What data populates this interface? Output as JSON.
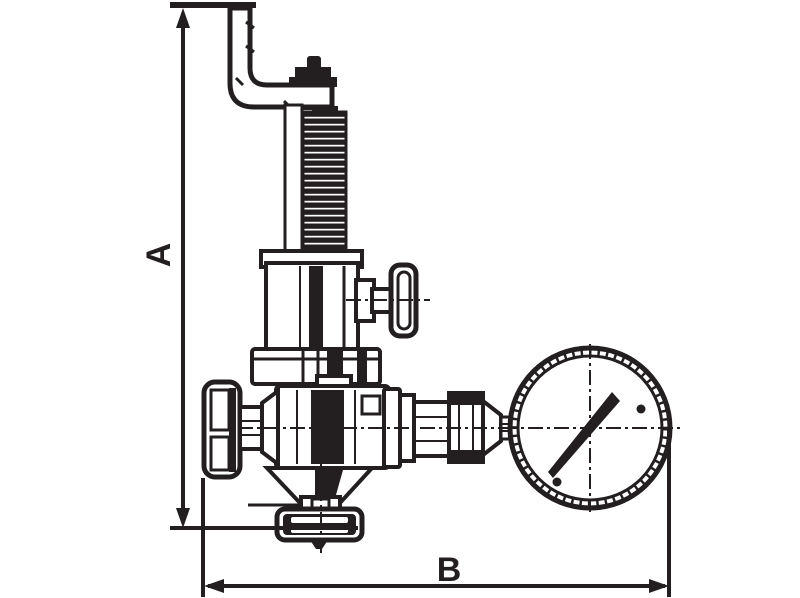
{
  "colors": {
    "ink": "#231f20",
    "paper": "#ffffff"
  },
  "drawing": {
    "dimension_labels": {
      "height": "A",
      "width": "B"
    }
  }
}
